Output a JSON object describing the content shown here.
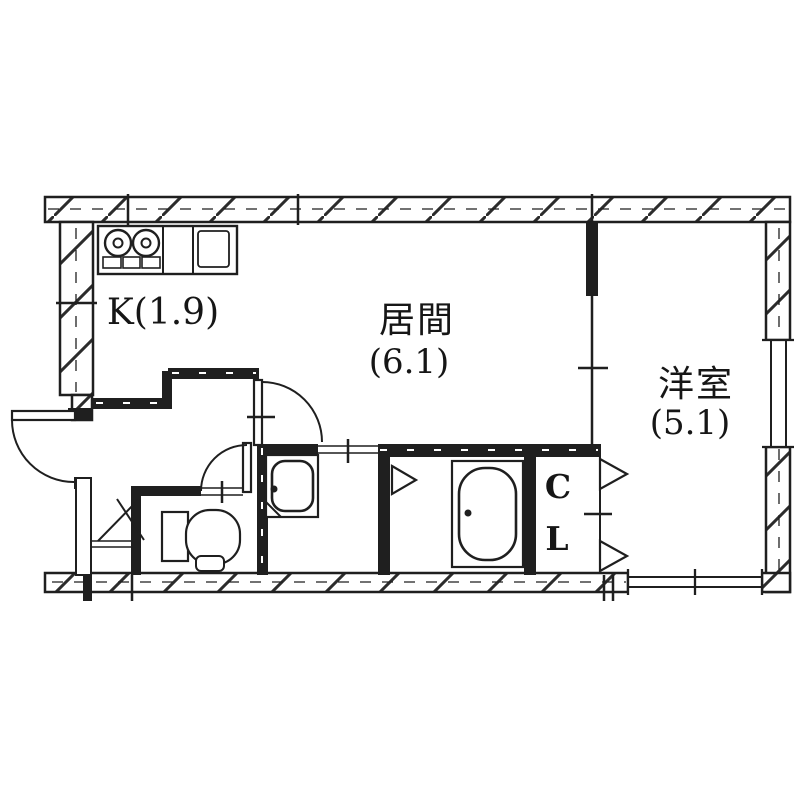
{
  "colors": {
    "ink": "#1f1f1f",
    "background": "#ffffff"
  },
  "labels": {
    "kitchen": "K(1.9)",
    "living_name": "居間",
    "living_size": "(6.1)",
    "western_name": "洋室",
    "western_size": "(5.1)",
    "closet_line1": "C",
    "closet_line2": "L"
  },
  "rooms": [
    {
      "label": "K(1.9)",
      "type": "kitchen"
    },
    {
      "label": "居間 (6.1)",
      "type": "living-room"
    },
    {
      "label": "洋室 (5.1)",
      "type": "western-room"
    },
    {
      "label": "CL",
      "type": "closet"
    }
  ]
}
